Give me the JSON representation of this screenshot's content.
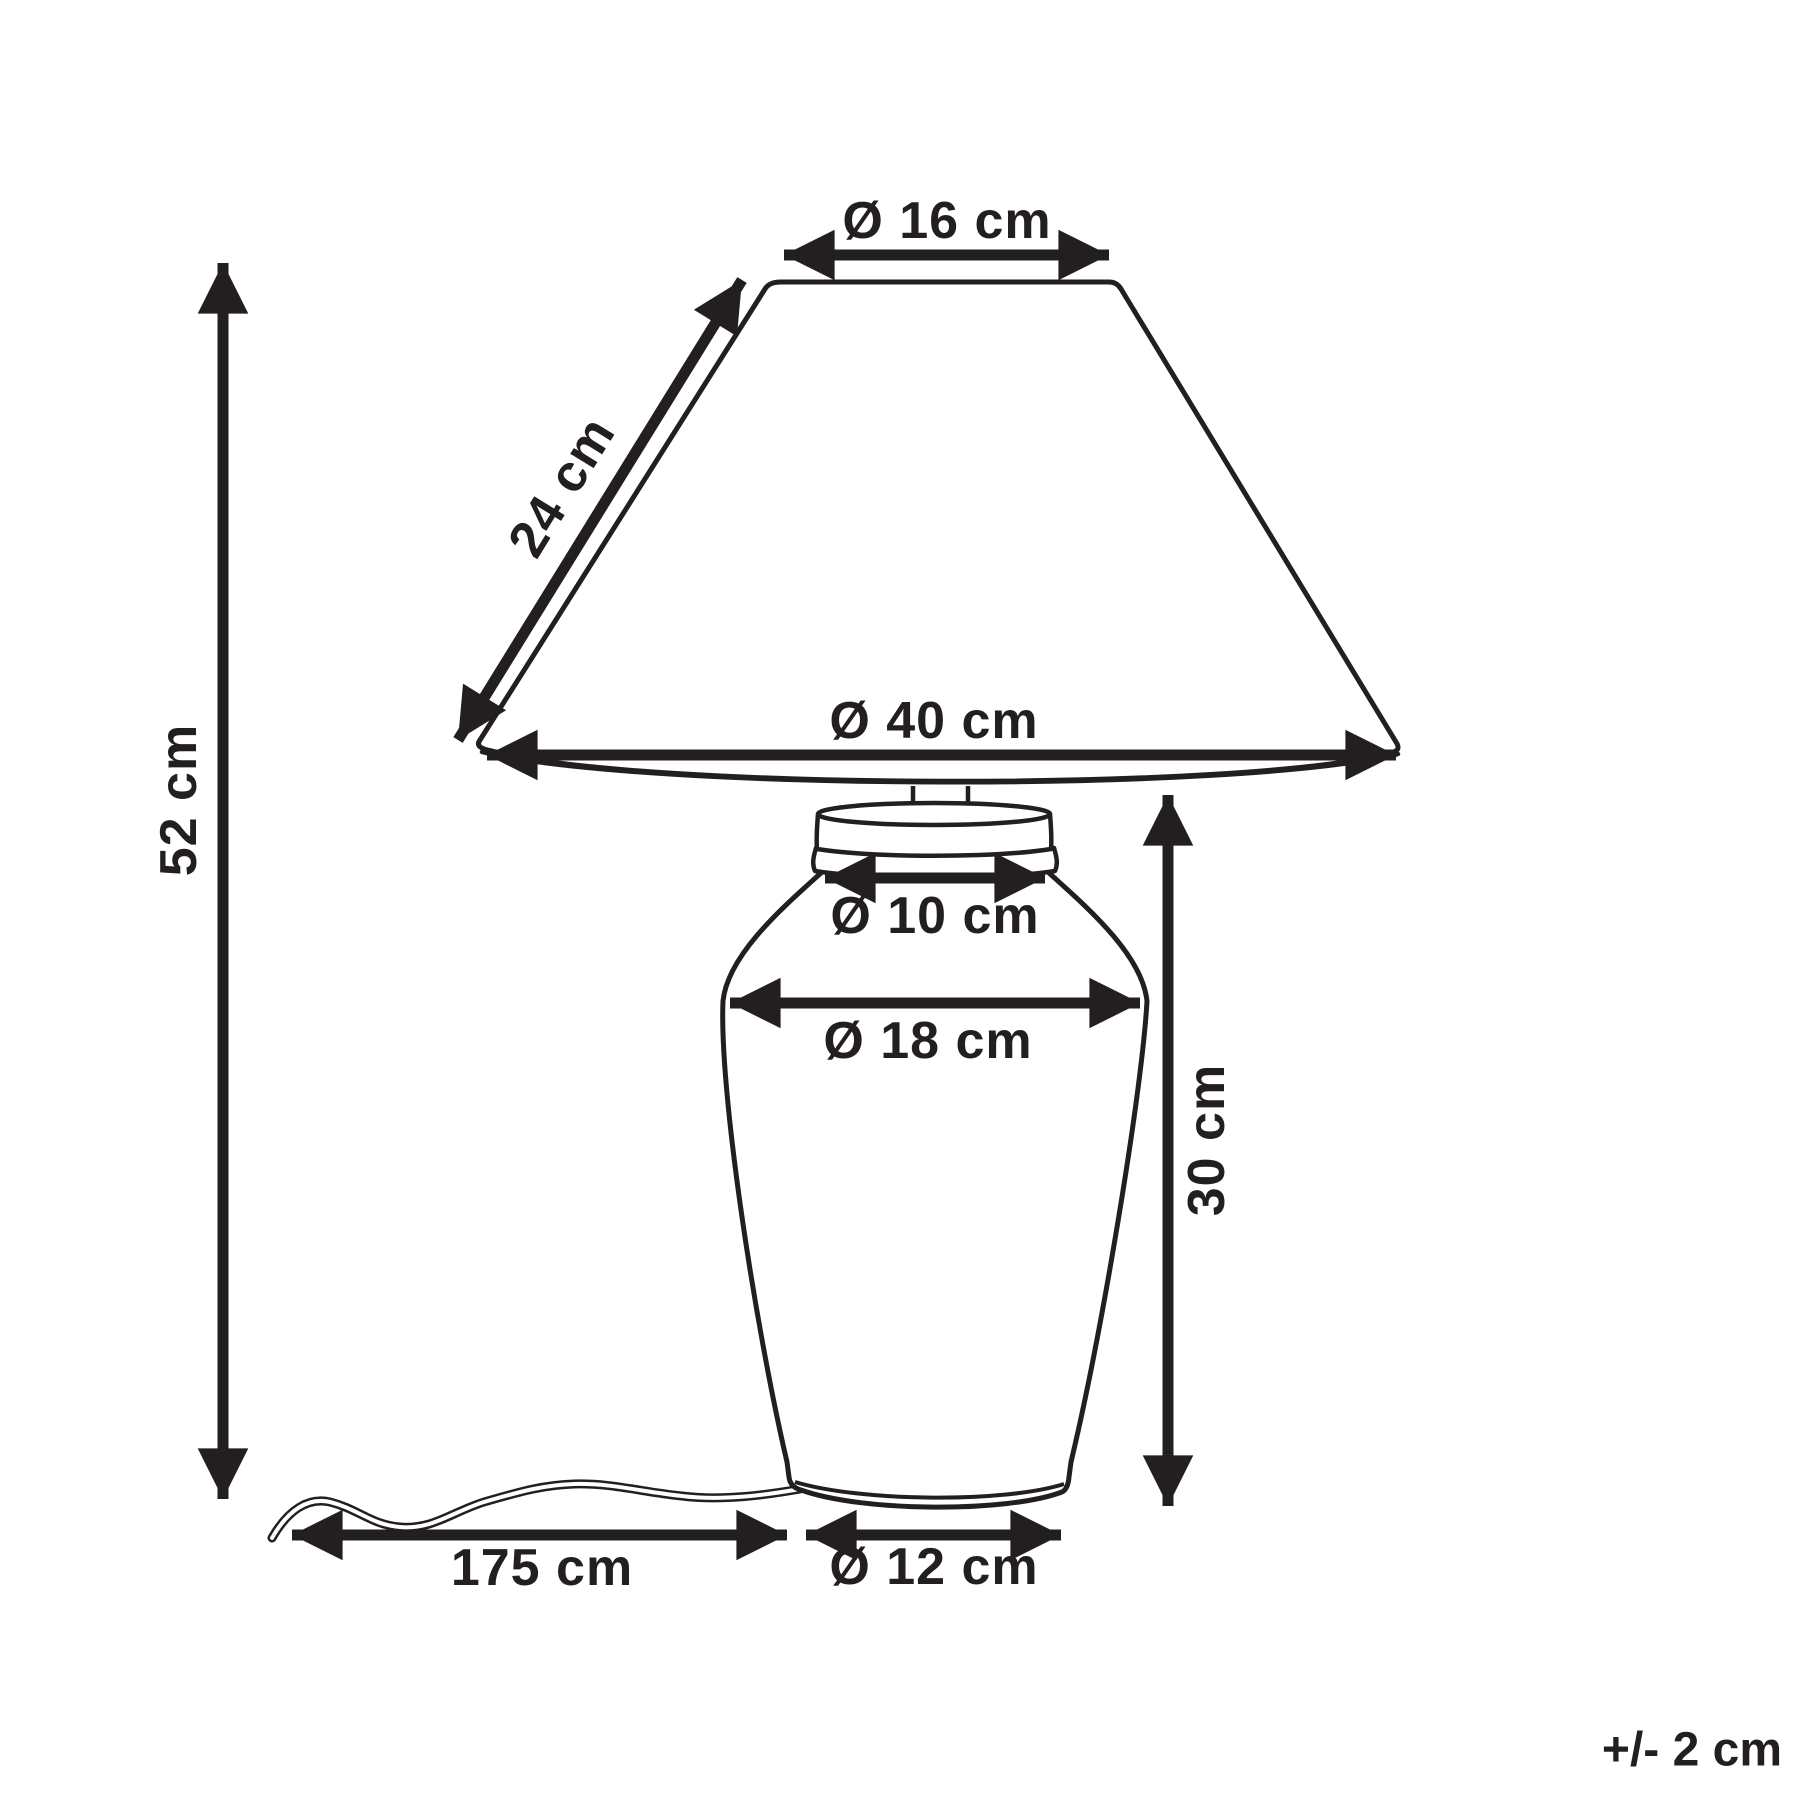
{
  "diagram": {
    "subject": "table-lamp-dimension-drawing",
    "tolerance_note": "+/- 2 cm",
    "colors": {
      "line": "#231f20",
      "background": "#ffffff"
    },
    "dimensions": {
      "shade_top_diameter": "Ø 16 cm",
      "shade_slant_height": "24 cm",
      "shade_bottom_diameter": "Ø 40 cm",
      "neck_diameter": "Ø 10 cm",
      "body_diameter": "Ø 18 cm",
      "base_height": "30 cm",
      "total_height": "52 cm",
      "cable_length": "175 cm",
      "foot_diameter": "Ø 12 cm"
    }
  }
}
